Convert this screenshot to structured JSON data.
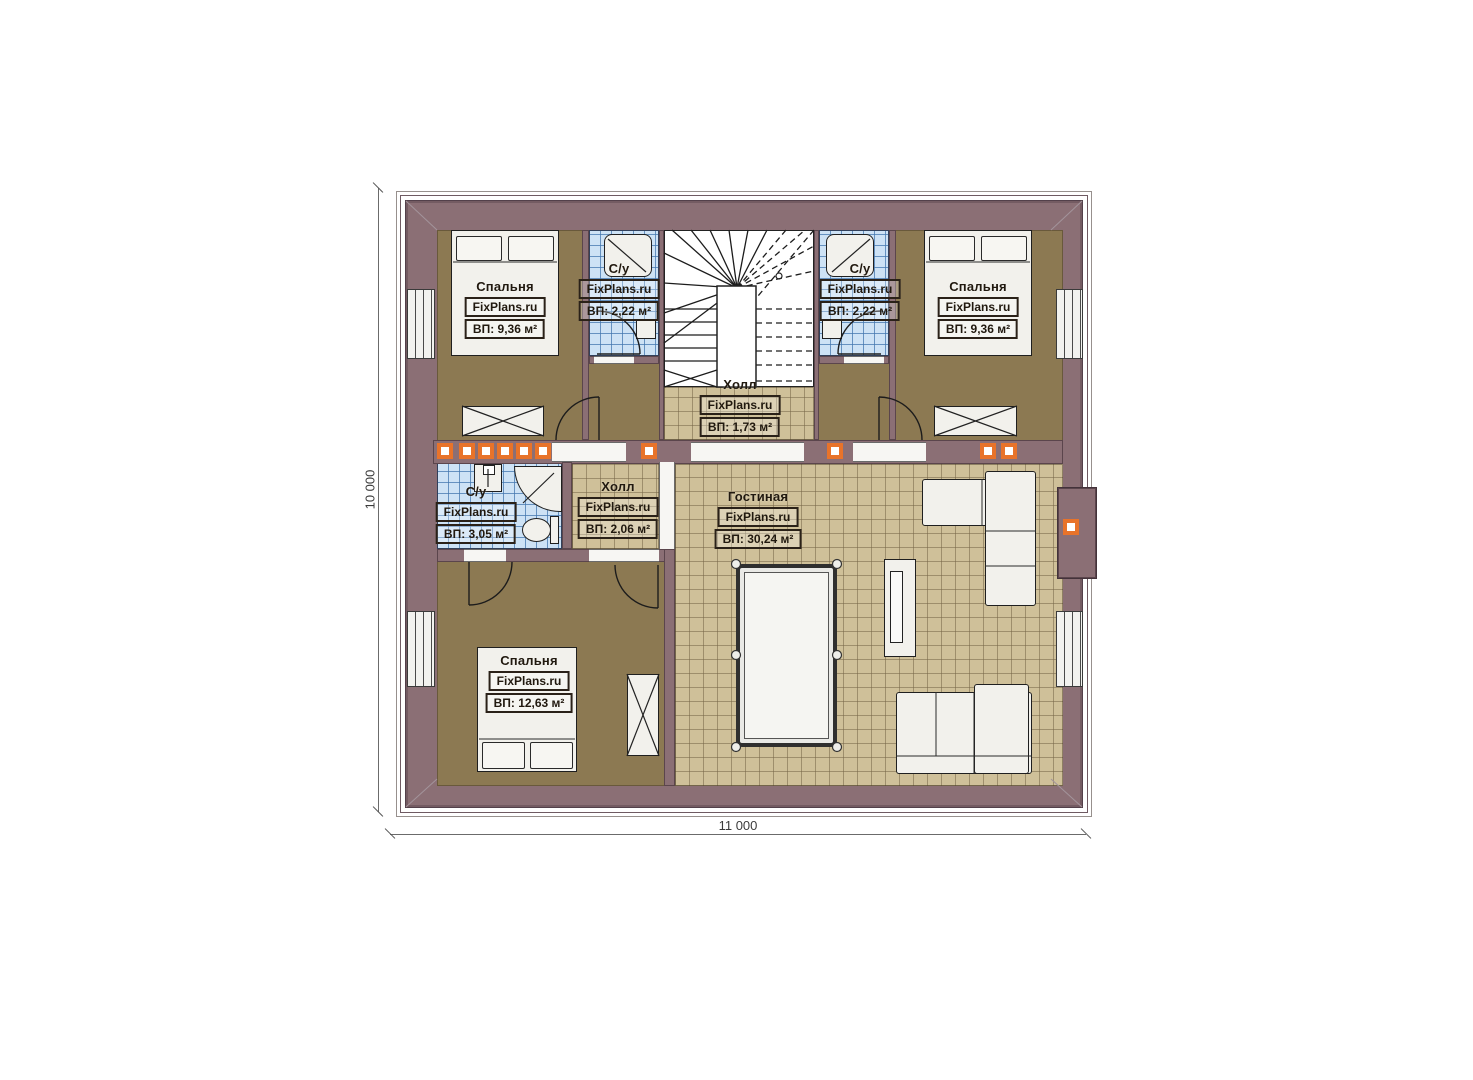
{
  "plan": {
    "brand": "FixPlans.ru",
    "dimensions": {
      "width_label": "11 000",
      "height_label": "10 000"
    },
    "rooms": {
      "bedroom_top_left": {
        "name": "Спальня",
        "brand": "FixPlans.ru",
        "area": "ВП: 9,36 м²"
      },
      "bathroom_top_left": {
        "name": "С/у",
        "brand": "FixPlans.ru",
        "area": "ВП: 2,22 м²"
      },
      "hall_upper": {
        "name": "Холл",
        "brand": "FixPlans.ru",
        "area": "ВП: 1,73 м²"
      },
      "bathroom_top_right": {
        "name": "С/у",
        "brand": "FixPlans.ru",
        "area": "ВП: 2,22 м²"
      },
      "bedroom_top_right": {
        "name": "Спальня",
        "brand": "FixPlans.ru",
        "area": "ВП: 9,36 м²"
      },
      "bathroom_lower_left": {
        "name": "С/у",
        "brand": "FixPlans.ru",
        "area": "ВП: 3,05 м²"
      },
      "hall_lower": {
        "name": "Холл",
        "brand": "FixPlans.ru",
        "area": "ВП: 2,06 м²"
      },
      "living_room": {
        "name": "Гостиная",
        "brand": "FixPlans.ru",
        "area": "ВП: 30,24 м²"
      },
      "bedroom_bottom_left": {
        "name": "Спальня",
        "brand": "FixPlans.ru",
        "area": "ВП: 12,63 м²"
      }
    },
    "colors": {
      "wall": "#8b6f75",
      "bedroom_floor": "#8c7952",
      "tile_floor": "#cfc099",
      "bathroom_tile": "#cde2f5",
      "stairs": "#ffffff",
      "accent_orange": "#e8732a"
    }
  }
}
